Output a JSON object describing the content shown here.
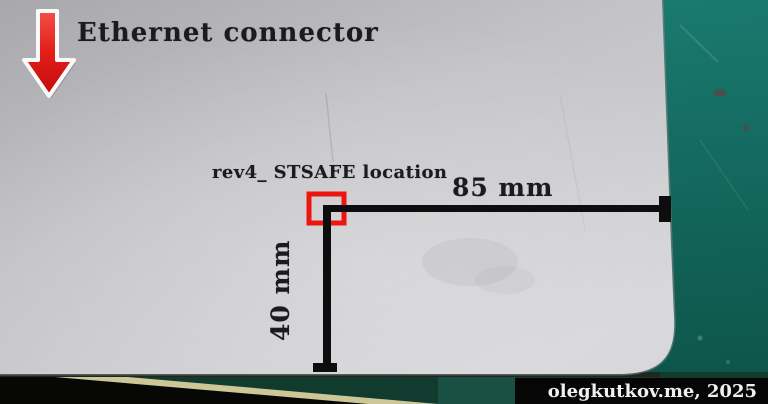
{
  "annotations": {
    "ethernet_label": "Ethernet connector",
    "stsafe_label": "rev4_ STSAFE location",
    "horizontal_dimension": "85 mm",
    "vertical_dimension": "40 mm"
  },
  "watermark": {
    "text": "olegkutkov.me, 2025"
  },
  "icons": {
    "arrow": "down-arrow-icon"
  },
  "colors": {
    "annotation_red": "#ee1510",
    "dimension_black": "#0d0d0d",
    "mat_teal": "#14695f",
    "board_gray": "#c6c6ca",
    "ruler_yellow": "#cdc697",
    "watermark_bg": "#060606",
    "watermark_text": "#f0f0f0"
  }
}
